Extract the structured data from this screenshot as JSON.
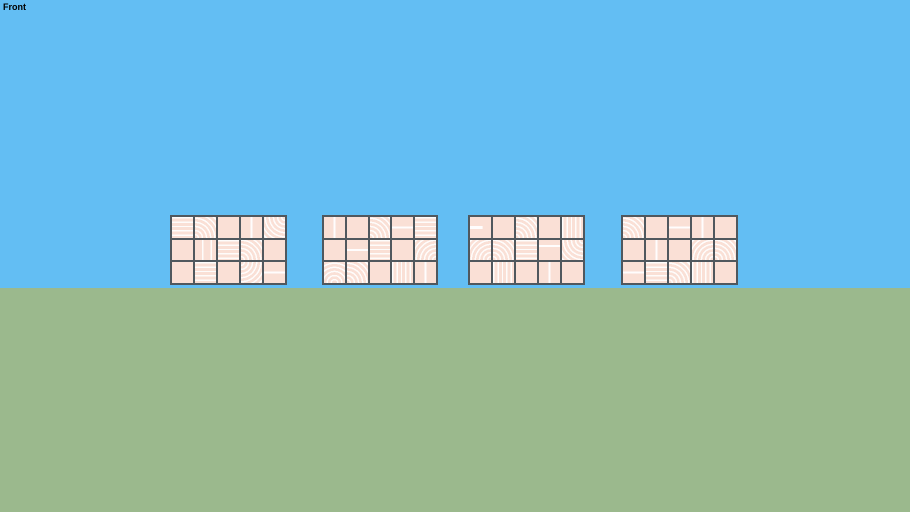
{
  "app": {
    "view_label": "Front"
  },
  "scene": {
    "sky_color": "#63BEF3",
    "ground_color": "#9BB98D",
    "horizon_y": 288,
    "tile_color": "#FAE0D6",
    "pattern_line_color": "#FFFFFF",
    "frame_color": "#50585E"
  },
  "panels": [
    {
      "name": "panel-1",
      "left": 170,
      "top": 215,
      "width": 117,
      "height": 70,
      "tiles": [
        [
          "hstripes",
          "arc-bl",
          "plain",
          "vline",
          "arc-tr"
        ],
        [
          "plain",
          "vlines2",
          "hstripes",
          "arc-bl",
          "plain"
        ],
        [
          "plain",
          "hstripes",
          "plain",
          "arc-tl",
          "hline"
        ]
      ]
    },
    {
      "name": "panel-2",
      "left": 322,
      "top": 215,
      "width": 116,
      "height": 70,
      "tiles": [
        [
          "vline",
          "plain",
          "arc-bl",
          "hline",
          "hstripes"
        ],
        [
          "plain",
          "hline",
          "hstripes",
          "plain",
          "arc-br"
        ],
        [
          "arc-bc",
          "arc-bl",
          "plain",
          "vstripes",
          "vline"
        ]
      ]
    },
    {
      "name": "panel-3",
      "left": 468,
      "top": 215,
      "width": 117,
      "height": 70,
      "tiles": [
        [
          "hline-left",
          "plain",
          "arc-bl",
          "plain",
          "vstripes"
        ],
        [
          "arc-br",
          "arc-bl",
          "hstripes",
          "hline-top",
          "arc-tr"
        ],
        [
          "plain",
          "vstripes",
          "plain",
          "vline",
          "plain"
        ]
      ]
    },
    {
      "name": "panel-4",
      "left": 621,
      "top": 215,
      "width": 117,
      "height": 70,
      "tiles": [
        [
          "arc-bl",
          "plain",
          "hline",
          "vline",
          "plain"
        ],
        [
          "plain",
          "vline",
          "plain",
          "arc-br",
          "arc-bl"
        ],
        [
          "hline",
          "hstripes",
          "arc-bl",
          "vstripes",
          "plain"
        ]
      ]
    }
  ]
}
